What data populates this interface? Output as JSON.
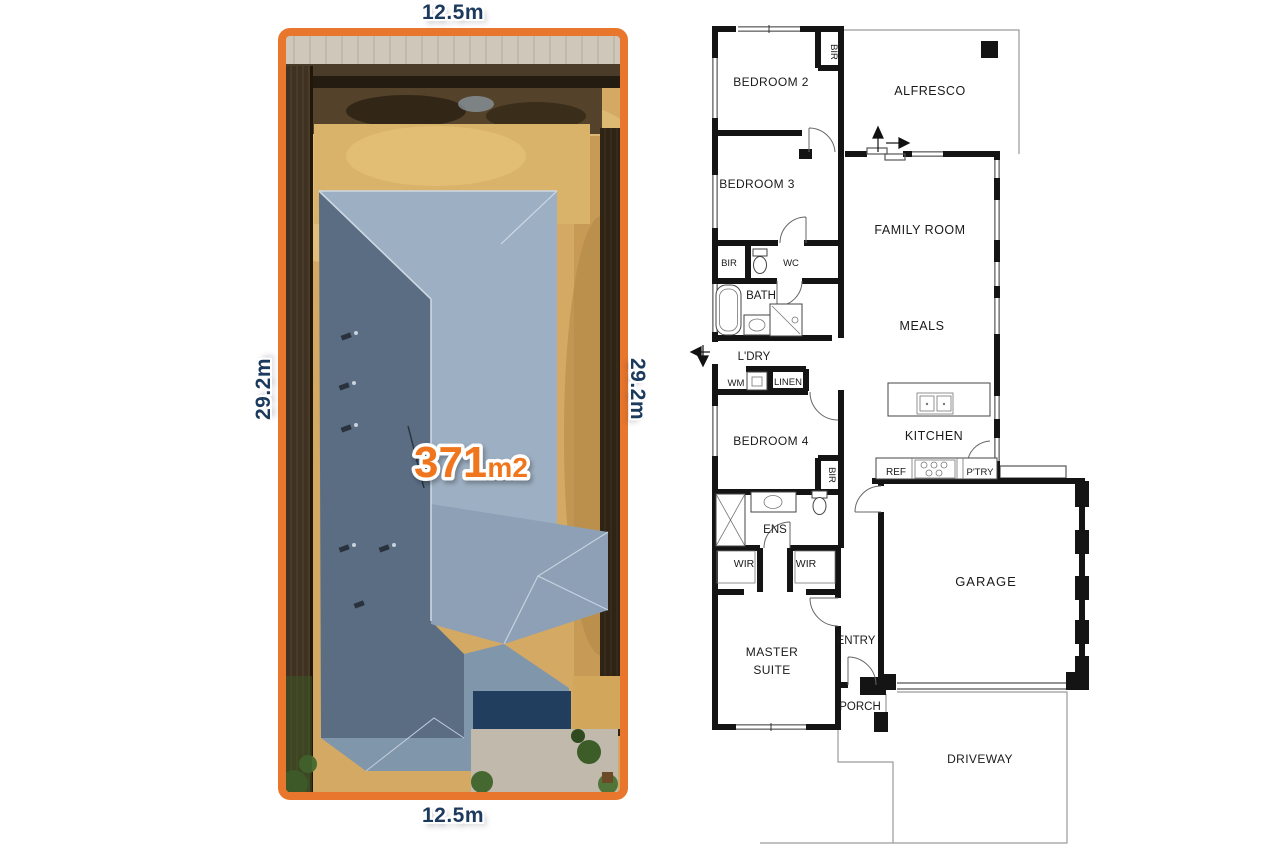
{
  "site": {
    "dimensions": {
      "top": "12.5m",
      "bottom": "12.5m",
      "left": "29.2m",
      "right": "29.2m"
    },
    "area": {
      "value": "371",
      "unit": "m2"
    },
    "colors": {
      "border_orange": "#E8762C",
      "dimension_text": "#1C3A5E",
      "area_text": "#F0761E"
    }
  },
  "plan": {
    "rooms": {
      "bedroom2": "BEDROOM 2",
      "bir_bedroom2": "BIR",
      "alfresco": "ALFRESCO",
      "bedroom3": "BEDROOM 3",
      "bir_hall": "BIR",
      "wc": "WC",
      "bath": "BATH",
      "family_room": "FAMILY ROOM",
      "meals": "MEALS",
      "laundry": "L'DRY",
      "wm": "WM",
      "linen": "LINEN",
      "bedroom4": "BEDROOM 4",
      "bir_bedroom4": "BIR",
      "kitchen": "KITCHEN",
      "ref": "REF",
      "pantry": "P'TRY",
      "ensuite": "ENS",
      "wir_left": "WIR",
      "wir_right": "WIR",
      "garage": "GARAGE",
      "master_line1": "MASTER",
      "master_line2": "SUITE",
      "entry": "ENTRY",
      "porch": "PORCH",
      "driveway": "DRIVEWAY"
    }
  }
}
